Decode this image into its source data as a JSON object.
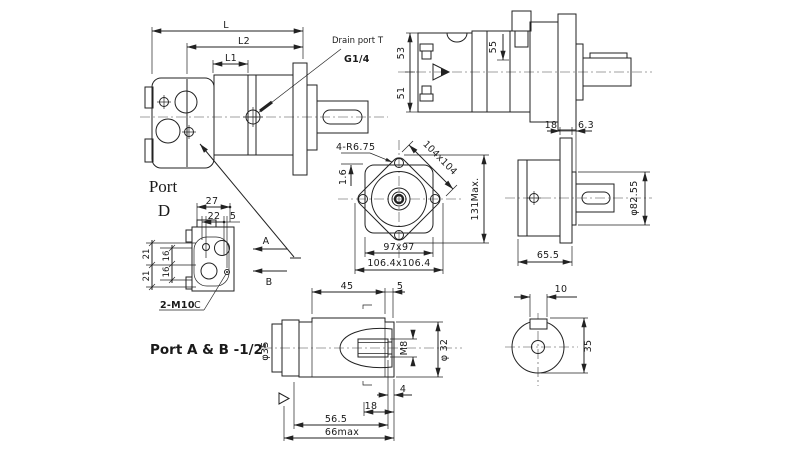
{
  "drawing": {
    "type": "hydraulic-motor-technical-drawing",
    "colors": {
      "line": "#222222",
      "background": "#ffffff"
    },
    "main_view": {
      "dim_L": "L",
      "dim_L2": "L2",
      "dim_L1": "L1",
      "drain_port_label": "Drain port T",
      "drain_thread": "G1/4"
    },
    "rear_view": {
      "dim_top": "53",
      "dim_bottom": "51",
      "dim_depth": "55"
    },
    "flange_view": {
      "bolt_note": "4-R6.75",
      "dim_diag": "104x104",
      "dim_chamfer": "1.6",
      "dim_height": "131Max.",
      "dim_square": "97x97",
      "dim_outer": "106.4x106.4"
    },
    "output_view": {
      "dim_flange": "18",
      "dim_step": "6.3",
      "dim_pilot": "φ82.55",
      "dim_length": "65.5"
    },
    "port_view": {
      "title_line1": "Port",
      "title_line2": "D",
      "dim_27": "27",
      "dim_22": "22",
      "dim_5": "5",
      "dim_21a": "21",
      "dim_21b": "21",
      "dim_16a": "16",
      "dim_16b": "16",
      "bolt_note": "2-M10",
      "datum": "C",
      "arrow_a": "A",
      "arrow_b": "B"
    },
    "shaft_view": {
      "note": "Port A & B -1/2'",
      "dim_45": "45",
      "dim_5": "5",
      "dim_d35": "φ35",
      "dim_m8": "M8",
      "dim_d32": "φ 32",
      "dim_4": "4",
      "dim_18": "18",
      "dim_565": "56.5",
      "dim_66": "66max"
    },
    "section_view": {
      "dim_key": "10",
      "dim_35": "35"
    }
  }
}
